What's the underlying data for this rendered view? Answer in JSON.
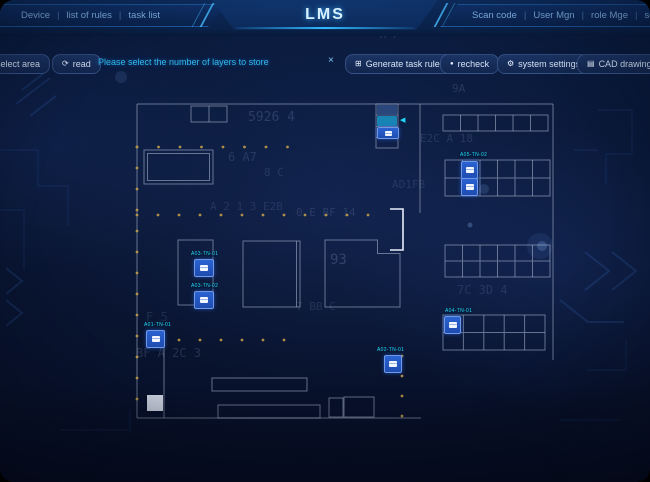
{
  "header": {
    "title": "LMS",
    "separator": "|",
    "left_nav": [
      {
        "label": "Device"
      },
      {
        "label": "list of rules"
      },
      {
        "label": "task list"
      }
    ],
    "right_nav": [
      {
        "label": "Scan code"
      },
      {
        "label": "User Mgn"
      },
      {
        "label": "role Mge"
      },
      {
        "label": "set"
      }
    ]
  },
  "toolbar": {
    "select_area_label": "select area",
    "read_label": "read",
    "message": "Please select the number of layers to store",
    "generate_label": "Generate task rules",
    "recheck_label": "recheck",
    "system_settings_label": "system settings",
    "cad_settings_label": "CAD drawing settings"
  },
  "icons": {
    "read": "⟳",
    "generate": "⊞",
    "recheck": "●",
    "settings": "⚙",
    "cad": "▤",
    "close": "×",
    "arrow_left": "◀"
  },
  "map": {
    "rack_labels": [
      {
        "label": "A05-TN-02"
      },
      {
        "label": "A04-TN-01"
      }
    ],
    "markers": [
      {
        "label": "A03-TN-01"
      },
      {
        "label": "A03-TN-02"
      },
      {
        "label": "A01-TN-01"
      },
      {
        "label": "A02-TN-01"
      }
    ]
  },
  "colors": {
    "accent_cyan": "#2fb9f0",
    "marker_blue": "#2257c4",
    "cad_line": "#9aa7c4",
    "dot_orange": "#caa24a",
    "background_navy": "#0a1735"
  },
  "background": {
    "matrix": [
      {
        "text": "5926 4"
      },
      {
        "text": "6 A7"
      },
      {
        "text": "8 C"
      },
      {
        "text": "0 E BF 14"
      },
      {
        "text": "93"
      },
      {
        "text": "7 BB C"
      },
      {
        "text": "BF A 2C 3"
      },
      {
        "text": "E2C A 18"
      },
      {
        "text": "7C 3D 4"
      },
      {
        "text": "AD1FB"
      },
      {
        "text": "9A"
      },
      {
        "text": "A 7"
      },
      {
        "text": "A 2 1 3 E2B"
      },
      {
        "text": "F 5"
      }
    ]
  }
}
